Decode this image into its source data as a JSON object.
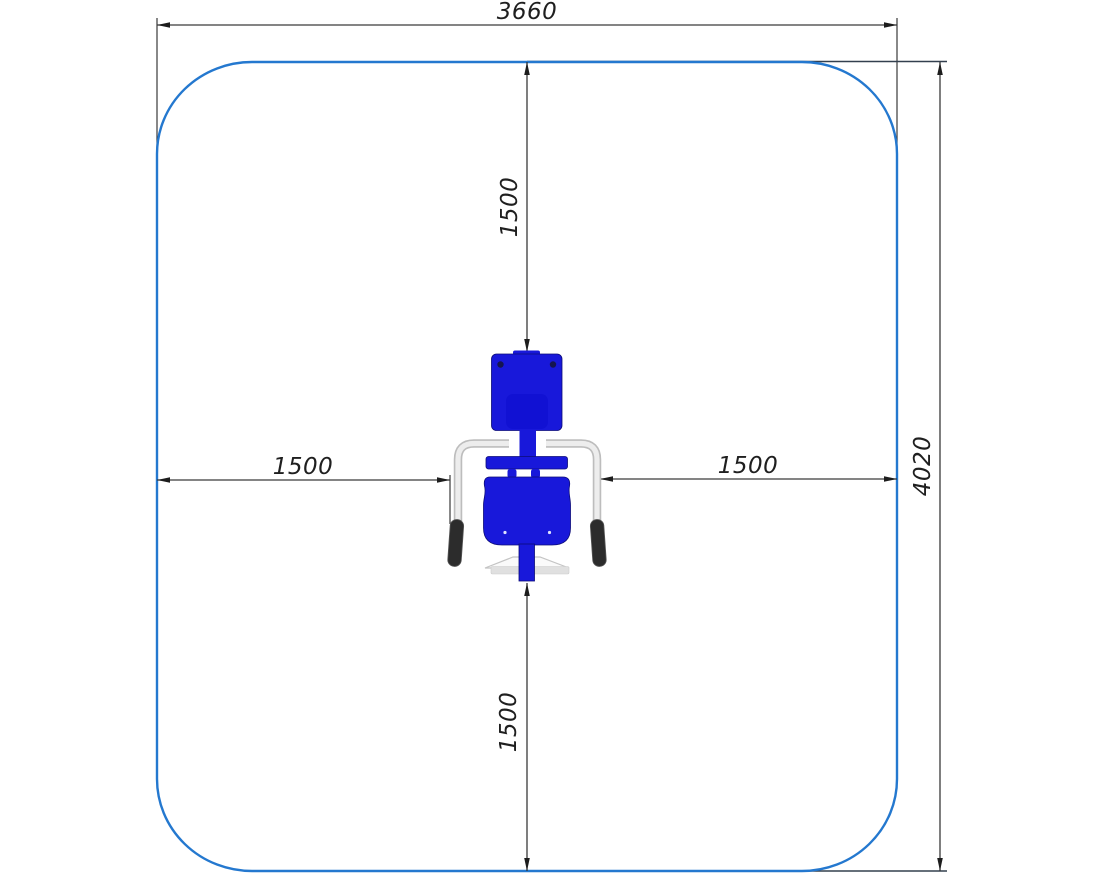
{
  "drawing": {
    "type": "top-view safety-zone plan of outdoor exercise equipment",
    "dims": {
      "width": "3660",
      "height": "4020",
      "offset_top": "1500",
      "offset_bottom": "1500",
      "offset_left": "1500",
      "offset_right": "1500"
    },
    "colors": {
      "safety_zone_outline": "#2478cf",
      "equipment_blue": "#1818da",
      "dimension_line": "#3a3a3a",
      "grip_dark": "#2c2c2c",
      "tube_gray": "#ededed",
      "background": "#ffffff"
    }
  }
}
